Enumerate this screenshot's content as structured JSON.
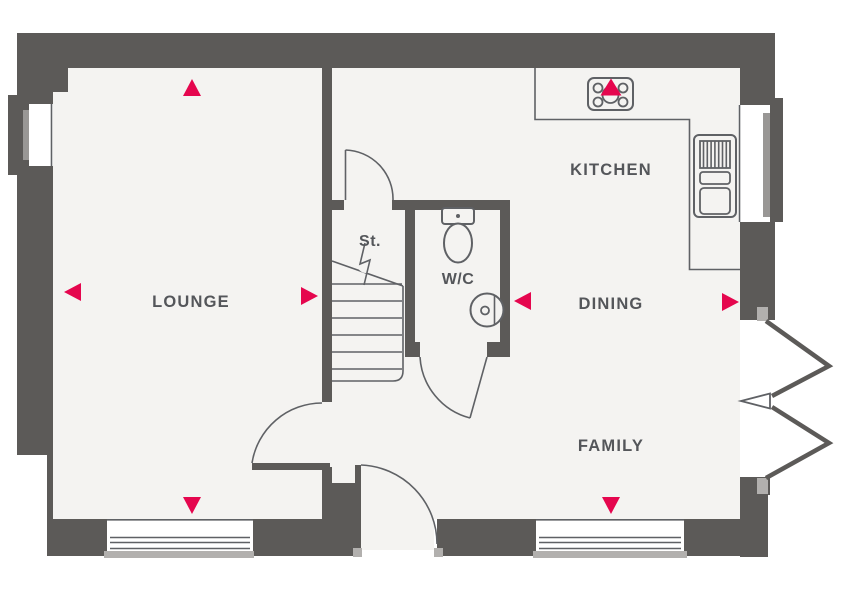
{
  "plan": {
    "type": "ground-floor-plan",
    "labels": {
      "lounge": "LOUNGE",
      "kitchen": "KITCHEN",
      "dining": "DINING",
      "family": "FAMILY",
      "wc": "W/C",
      "store": "St."
    },
    "rooms": [
      {
        "id": "lounge",
        "label": "LOUNGE"
      },
      {
        "id": "kitchen",
        "label": "KITCHEN"
      },
      {
        "id": "dining",
        "label": "DINING"
      },
      {
        "id": "family",
        "label": "FAMILY"
      },
      {
        "id": "wc",
        "label": "W/C"
      },
      {
        "id": "store",
        "label": "St."
      }
    ],
    "markers": {
      "lounge": [
        "up",
        "left",
        "right",
        "down"
      ],
      "kitchen": [
        "up"
      ],
      "dining": [
        "left",
        "right"
      ],
      "family": [
        "down"
      ]
    },
    "icons": [
      "hob-icon",
      "appliance-icon",
      "toilet-icon",
      "basin-icon",
      "stairs-icon",
      "stair-break-icon",
      "door-swing-icon",
      "french-doors-icon",
      "window-icon",
      "direction-arrow-icon"
    ]
  },
  "colors": {
    "wall": "#5c5a58",
    "floor": "#f4f3f1",
    "line": "#5f6165",
    "text": "#54565a",
    "accent": "#e5064e",
    "sill": "#999795",
    "jamb": "#b2b0ae",
    "background": "#ffffff"
  }
}
